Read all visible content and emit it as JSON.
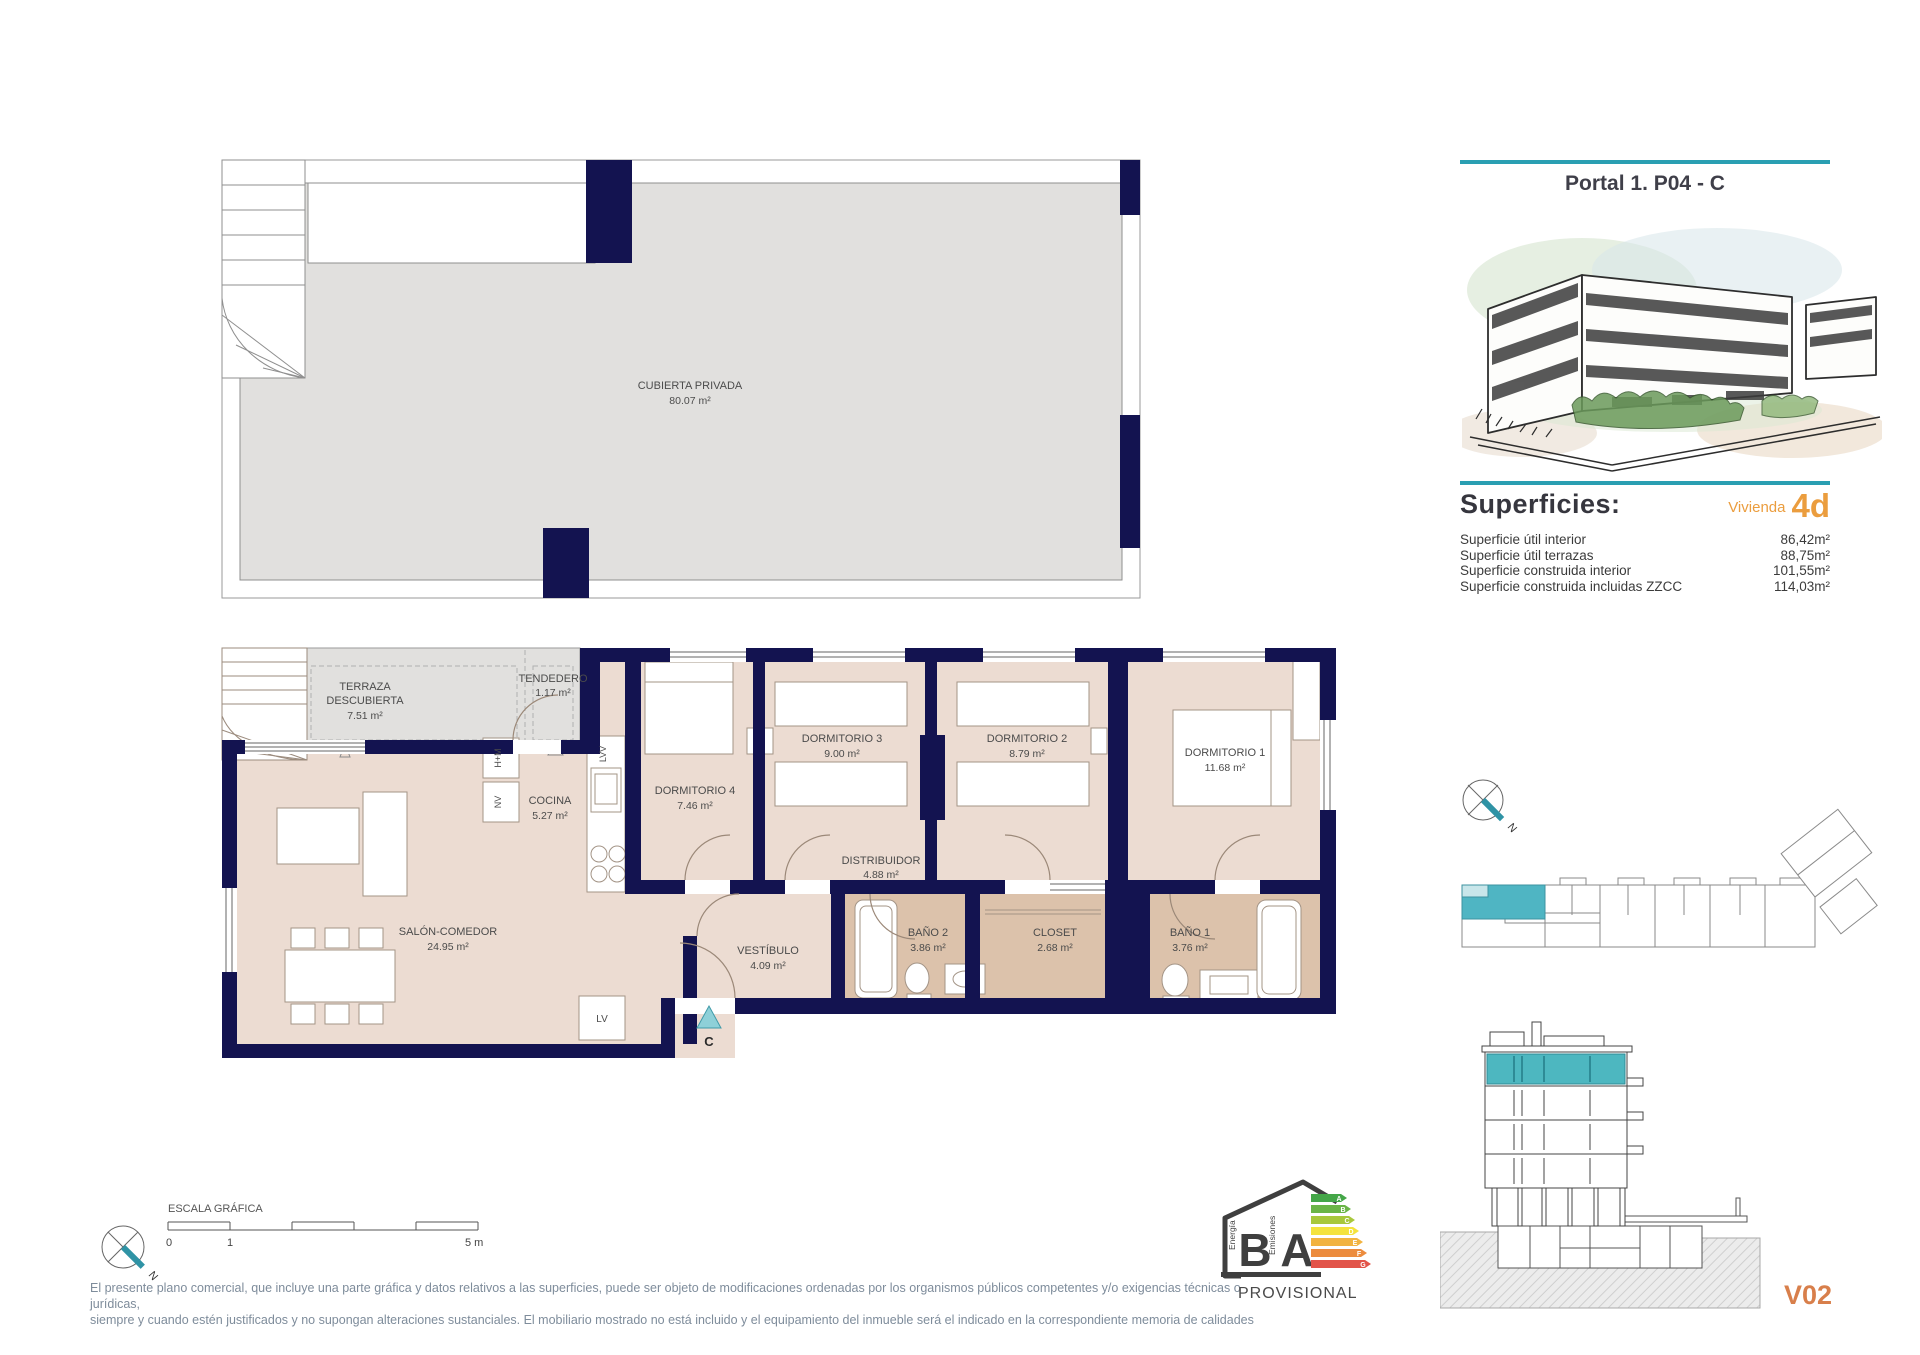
{
  "header": {
    "title": "Portal 1. P04 - C"
  },
  "superficies": {
    "heading": "Superficies:",
    "vivienda_label": "Vivienda",
    "vivienda_code": "4d",
    "rows": [
      {
        "label": "Superficie útil interior",
        "value": "86,42m²"
      },
      {
        "label": "Superficie útil terrazas",
        "value": "88,75m²"
      },
      {
        "label": "Superficie construida interior",
        "value": "101,55m²"
      },
      {
        "label": "Superficie construida incluidas ZZCC",
        "value": "114,03m²"
      }
    ]
  },
  "roof": {
    "name": "CUBIERTA PRIVADA",
    "area": "80.07 m²"
  },
  "plan": {
    "terraza": {
      "line1": "TERRAZA",
      "line2": "DESCUBIERTA",
      "area": "7.51 m²"
    },
    "tendedero": {
      "name": "TENDEDERO",
      "area": "1.17 m²"
    },
    "cocina": {
      "name": "COCINA",
      "area": "5.27 m²"
    },
    "dormitorio4": {
      "name": "DORMITORIO 4",
      "area": "7.46 m²"
    },
    "dormitorio3": {
      "name": "DORMITORIO 3",
      "area": "9.00 m²"
    },
    "dormitorio2": {
      "name": "DORMITORIO 2",
      "area": "8.79 m²"
    },
    "dormitorio1": {
      "name": "DORMITORIO 1",
      "area": "11.68 m²"
    },
    "distribuidor": {
      "name": "DISTRIBUIDOR",
      "area": "4.88 m²"
    },
    "salon": {
      "name": "SALÓN-COMEDOR",
      "area": "24.95 m²"
    },
    "vestibulo": {
      "name": "VESTÍBULO",
      "area": "4.09 m²"
    },
    "bano2": {
      "name": "BAÑO 2",
      "area": "3.86 m²"
    },
    "closet": {
      "name": "CLOSET",
      "area": "2.68 m²"
    },
    "bano1": {
      "name": "BAÑO 1",
      "area": "3.76 m²"
    },
    "markers": {
      "hm": "H+M",
      "nv": "NV",
      "lvv": "LVV",
      "lv": "LV",
      "entrance": "C",
      "north": "N"
    }
  },
  "scale_bar": {
    "title": "ESCALA GRÁFICA",
    "tick0": "0",
    "tick1": "1",
    "tick5": "5 m"
  },
  "disclaimer": {
    "line1": "El presente plano comercial, que incluye una parte gráfica y datos relativos a las superficies, puede ser objeto de modificaciones ordenadas por los organismos públicos competentes y/o exigencias técnicas o jurídicas,",
    "line2": "siempre y cuando estén justificados y no supongan alteraciones sustanciales. El mobiliario mostrado no está incluido y el equipamiento del inmueble será el indicado en la correspondiente memoria de calidades"
  },
  "energy": {
    "letter_b": "B",
    "letter_a": "A",
    "left_caption": "Energía",
    "right_caption": "Emisiones",
    "status": "PROVISIONAL",
    "arrows": [
      {
        "letter": "A",
        "color": "#44a648"
      },
      {
        "letter": "B",
        "color": "#6ab547"
      },
      {
        "letter": "C",
        "color": "#a8c83c"
      },
      {
        "letter": "D",
        "color": "#f4e33d"
      },
      {
        "letter": "E",
        "color": "#f2b340"
      },
      {
        "letter": "F",
        "color": "#ec8c3e"
      },
      {
        "letter": "G",
        "color": "#e25449"
      }
    ]
  },
  "version": "V02",
  "colors": {
    "accent_teal": "#2a9fb2",
    "highlight_teal": "#4fb5c3",
    "wall_navy": "#131350",
    "vivienda_orange": "#eb9d3e",
    "version_orange": "#d87f4b"
  }
}
